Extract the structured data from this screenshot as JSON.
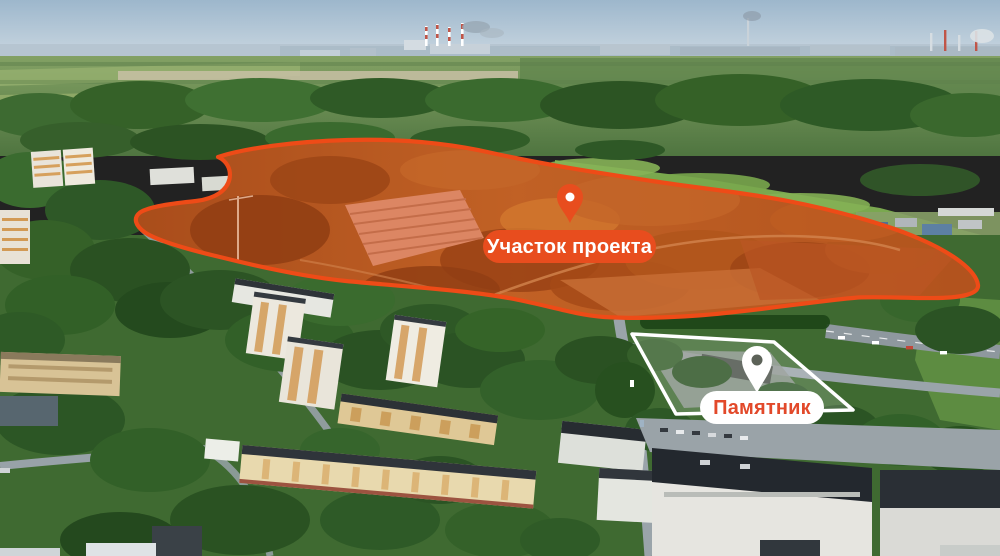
{
  "annotations": {
    "project_area": {
      "label": "Участок проекта",
      "marker": "map-pin-icon",
      "accent_color": "#E84D1E",
      "outline_color": "#EE4B17",
      "label_text_color": "#FFFFFF"
    },
    "monument": {
      "label": "Памятник",
      "marker": "map-pin-icon",
      "label_bg": "#FFFFFF",
      "label_text_color": "#E2492A",
      "outline_color": "#FFFFFF"
    }
  },
  "scene": {
    "type": "aerial-photo",
    "visible_features": [
      "sky",
      "industrial skyline with chimneys",
      "forest",
      "fields",
      "highlighted project site terrain",
      "residential district with apartment blocks",
      "roads",
      "industrial buildings"
    ]
  }
}
